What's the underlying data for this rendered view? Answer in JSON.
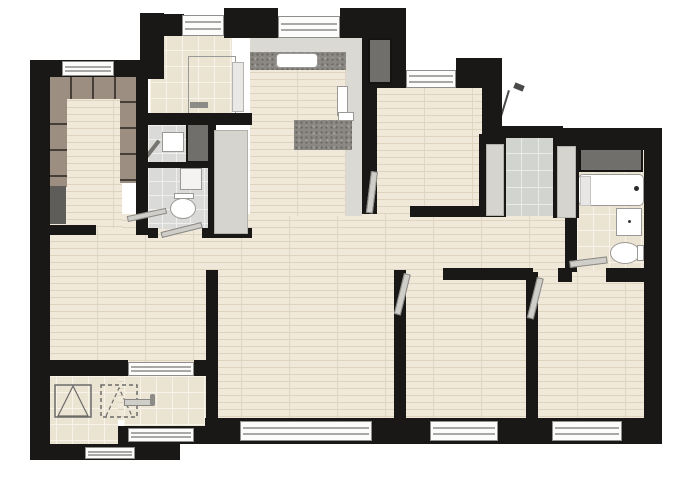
{
  "title": "apartment-floor-plan",
  "canvas": {
    "width": 676,
    "height": 486
  },
  "colors": {
    "wall": "#1a1816",
    "wood_base": "#f0e9da",
    "wood_line": "#ddd3be",
    "tile_beige": "#ece4d3",
    "tile_beige_grid": "#f8f3e9",
    "tile_gray": "#dadad8",
    "tile_gray_grid": "#efefed",
    "balcony_tile": "#d2d4d0",
    "balcony_grid": "#e9ebe7",
    "granite_base": "#8b8884",
    "granite_dark": "#6d6a66",
    "granite_light": "#a6a39e",
    "counter_gray": "#dbd9d4",
    "panel_gray": "#d6d4cf",
    "shaft_gray": "#716f6c",
    "cabinet_brown": "#9c8e80",
    "cabinet_brown_dark": "#453f38",
    "cabinet_dark": "#5f5d59",
    "window_fill": "#fcfcfb",
    "window_frame": "#8f8f8d",
    "window_bar": "#a8a8a6",
    "door_leaf": "#d0cec9",
    "door_edge": "#8a8884",
    "fixture_white": "#ffffff",
    "fixture_edge": "#9b9996",
    "annotation": "#4a4a48"
  },
  "legend": {
    "rooms": [
      "cloakroom",
      "laundry-room",
      "kitchen",
      "bedroom-1",
      "utility-niche",
      "bathroom-1",
      "bathroom-2",
      "living-dining-room",
      "hallway",
      "bedroom-2",
      "bedroom-3",
      "entry-foyer",
      "equipment-platform"
    ],
    "fixtures": [
      "wardrobe",
      "kitchen-sink",
      "kitchen-counter",
      "kitchen-island",
      "duct-shaft",
      "wall-sink",
      "toilet",
      "mirror-cabinet",
      "bathtub",
      "vanity",
      "bathtub-faucet",
      "shower-wand",
      "door-leaf",
      "window",
      "ac-unit-symbol-solid",
      "ac-unit-symbol-dashed",
      "entry-door-handle",
      "annotation-leader"
    ]
  }
}
